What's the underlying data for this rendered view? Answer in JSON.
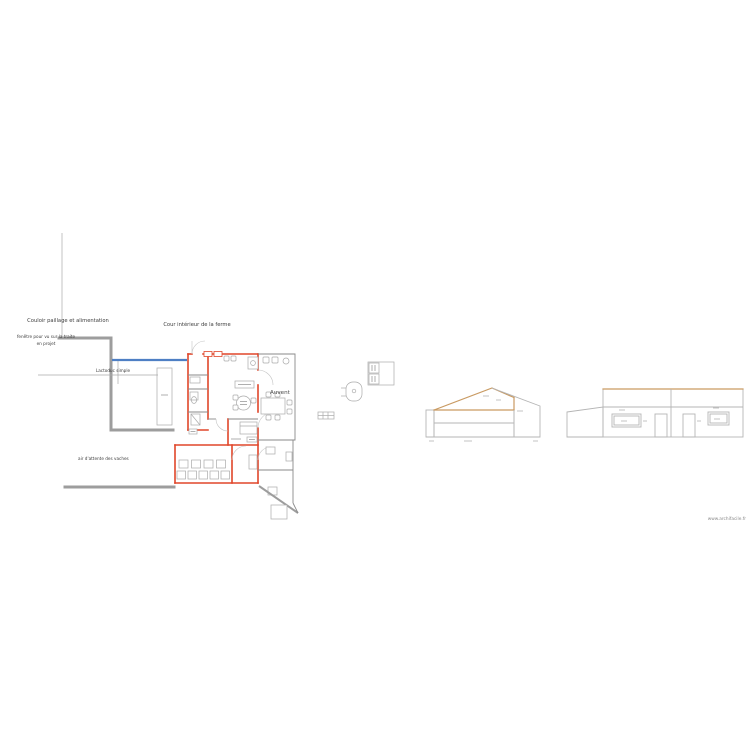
{
  "page": {
    "footer": "www.archifacile.fr",
    "background": "#ffffff"
  },
  "plan": {
    "labels": {
      "couloir": "Couloir paillage et alimentation",
      "cour": "Cour intérieur de la ferme",
      "fenetre_line1": "fenêtre pour vu sur la traite",
      "fenetre_line2": "en projet",
      "lactoduc": "Lactoduc simple",
      "auvent": "Auvent",
      "attente": "air d'attente des vaches"
    },
    "colors": {
      "wall_red": "#e0462a",
      "wall_gray": "#9d9d9d",
      "window_blue": "#4e7fc4",
      "roof_tan": "#c99a62",
      "elevation_gray": "#b5b5b5"
    }
  }
}
